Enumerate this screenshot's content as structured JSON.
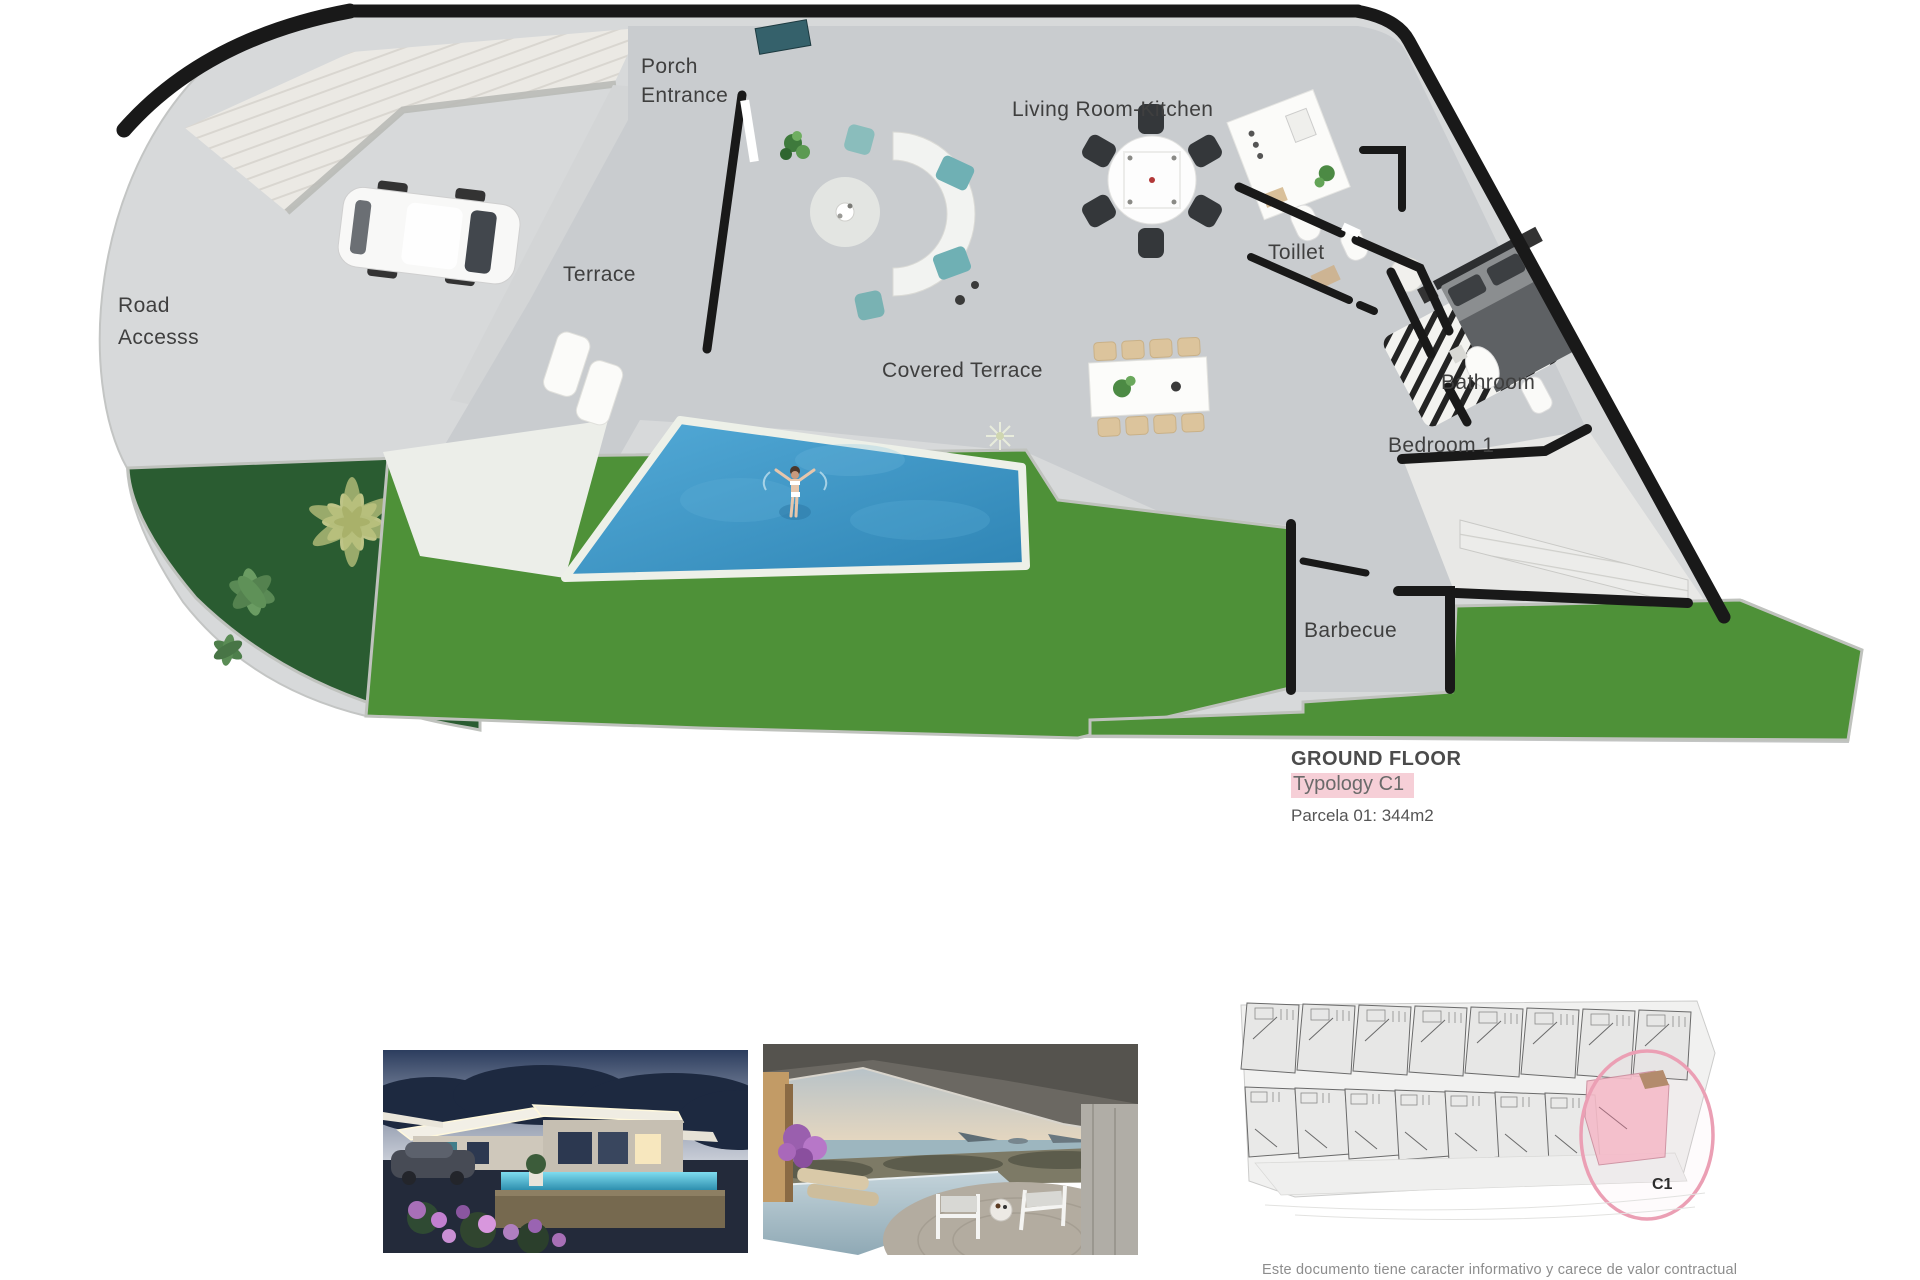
{
  "plan": {
    "labels": {
      "porch": "Porch\nEntrance",
      "living": "Living Room-Kitchen",
      "terrace": "Terrace",
      "road": "Road\nAccesss",
      "covered": "Covered Terrace",
      "toilet": "Toillet",
      "bathroom": "Bathroom",
      "bedroom1": "Bedroom 1",
      "barbecue": "Barbecue"
    },
    "title_block": {
      "floor": "GROUND FLOOR",
      "typology": "Typology C1",
      "parcel": "Parcela 01: 344m2"
    },
    "colors": {
      "lawn": "#4e9138",
      "garden_bed": "#2a5c31",
      "pool": "#3d97c6",
      "wall": "#191919",
      "highlight_pink": "#f6cfd7"
    }
  },
  "site_plan": {
    "unit_label": "C1",
    "highlight_color": "#f6bcc9",
    "circle_color": "#eb9fb4"
  },
  "footer": {
    "disclaimer": "Este documento tiene caracter informativo y carece de valor contractual"
  }
}
